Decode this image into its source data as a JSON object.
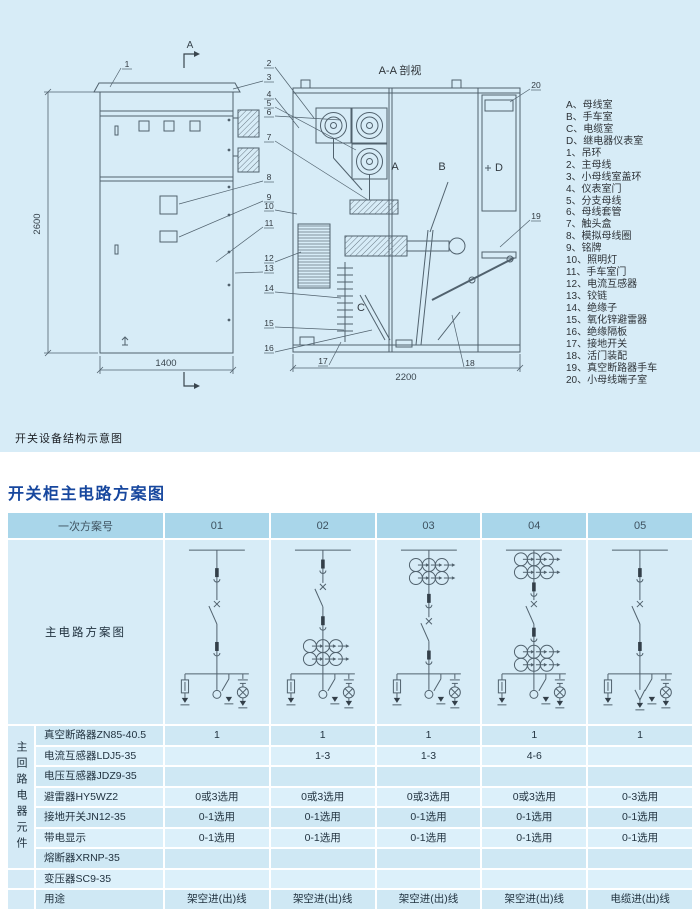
{
  "page": {
    "section1_caption": "开关设备结构示意图",
    "section2_title": "开关柜主电路方案图"
  },
  "colors": {
    "panel_bg": "#d7ecf7",
    "header_bg": "#a9d6ea",
    "cell_dark": "#cfe8f4",
    "cell_light": "#dcf0fa",
    "title_blue": "#17479e",
    "line": "#51626e"
  },
  "drawing": {
    "section_title": "A-A 剖视",
    "cut_mark": "A",
    "dim_height": "2600",
    "dim_width": "1400",
    "dim_depth": "2200",
    "compartments": [
      "A",
      "B",
      "C",
      "D"
    ],
    "callouts": [
      "1",
      "2",
      "3",
      "4",
      "5",
      "6",
      "7",
      "8",
      "9",
      "10",
      "11",
      "12",
      "13",
      "14",
      "15",
      "16",
      "17",
      "18",
      "19",
      "20"
    ],
    "legend": [
      "A、母线室",
      "B、手车室",
      "C、电缆室",
      "D、继电器仪表室",
      "1、吊环",
      "2、主母线",
      "3、小母线室盖环",
      "4、仪表室门",
      "5、分支母线",
      "6、母线套管",
      "7、触头盒",
      "8、模拟母线圈",
      "9、铭牌",
      "10、照明灯",
      "11、手车室门",
      "12、电流互感器",
      "13、铰链",
      "14、绝缘子",
      "15、氧化锌避雷器",
      "16、绝缘隔板",
      "17、接地开关",
      "18、活门装配",
      "19、真空断路器手车",
      "20、小母线端子室"
    ]
  },
  "table": {
    "header": {
      "first": "一次方案号",
      "schemes": [
        "01",
        "02",
        "03",
        "04",
        "05"
      ]
    },
    "diagram_row_label": "主电路方案图",
    "group_label": "主回路电器元件",
    "diagrams": [
      {
        "scheme": "01",
        "ct_above": false,
        "ct_below": false,
        "line": "overhead"
      },
      {
        "scheme": "02",
        "ct_above": false,
        "ct_below": true,
        "line": "overhead"
      },
      {
        "scheme": "03",
        "ct_above": true,
        "ct_below": false,
        "line": "overhead"
      },
      {
        "scheme": "04",
        "ct_above": true,
        "ct_below": true,
        "line": "overhead"
      },
      {
        "scheme": "05",
        "ct_above": false,
        "ct_below": false,
        "line": "cable"
      }
    ],
    "rows": [
      {
        "label": "真空断路器ZN85-40.5",
        "values": [
          "1",
          "1",
          "1",
          "1",
          "1"
        ]
      },
      {
        "label": "电流互感器LDJ5-35",
        "values": [
          "",
          "1-3",
          "1-3",
          "4-6",
          ""
        ]
      },
      {
        "label": "电压互感器JDZ9-35",
        "values": [
          "",
          "",
          "",
          "",
          ""
        ]
      },
      {
        "label": "避雷器HY5WZ2",
        "values": [
          "0或3选用",
          "0或3选用",
          "0或3选用",
          "0或3选用",
          "0-3选用"
        ]
      },
      {
        "label": "接地开关JN12-35",
        "values": [
          "0-1选用",
          "0-1选用",
          "0-1选用",
          "0-1选用",
          "0-1选用"
        ]
      },
      {
        "label": "带电显示",
        "values": [
          "0-1选用",
          "0-1选用",
          "0-1选用",
          "0-1选用",
          "0-1选用"
        ]
      },
      {
        "label": "熔断器XRNP-35",
        "values": [
          "",
          "",
          "",
          "",
          ""
        ]
      },
      {
        "label": "变压器SC9-35",
        "values": [
          "",
          "",
          "",
          "",
          ""
        ]
      },
      {
        "label": "用途",
        "values": [
          "架空进(出)线",
          "架空进(出)线",
          "架空进(出)线",
          "架空进(出)线",
          "电缆进(出)线"
        ]
      }
    ]
  }
}
